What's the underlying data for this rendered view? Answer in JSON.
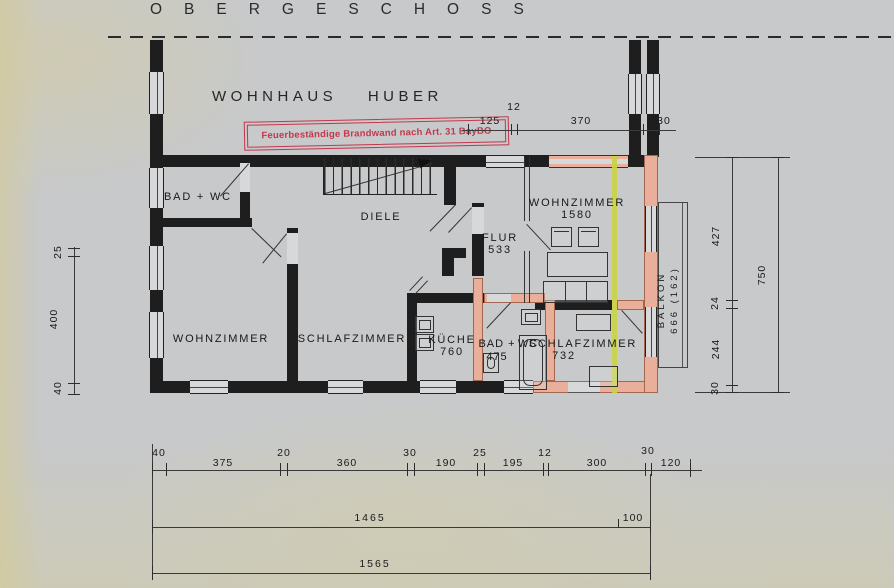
{
  "title": "OBERGESCHOSS",
  "building_label": "WOHNHAUS HUBER",
  "stamp": {
    "text": "Feuerbeständige Brandwand nach Art. 31 BayBO"
  },
  "rooms": {
    "bad_wc_top": {
      "label": "BAD + WC"
    },
    "diele": {
      "label": "DIELE"
    },
    "wohnzimmer_left": {
      "label": "WOHNZIMMER"
    },
    "schlafzimmer_left": {
      "label": "SCHLAFZIMMER"
    },
    "kueche": {
      "label": "KÜCHE",
      "area": "760"
    },
    "flur": {
      "label": "FLUR",
      "area": "533"
    },
    "bad_wc_new": {
      "label_left": "BAD +",
      "label_right": "WC",
      "area": "475"
    },
    "wohnzimmer_new": {
      "label": "WOHNZIMMER",
      "area": "1580"
    },
    "schlafzimmer_new": {
      "label": "SCHLAFZIMMER",
      "area": "732"
    },
    "balkon": {
      "label": "BALKON",
      "area": "666 (162)"
    }
  },
  "dims": {
    "top": [
      "125",
      "12",
      "370",
      "30"
    ],
    "left": [
      "25",
      "400",
      "40"
    ],
    "right_inner": [
      "427",
      "24",
      "244",
      "30"
    ],
    "right_outer": "750",
    "bottom_row1": [
      "40",
      "375",
      "20",
      "360",
      "30",
      "190",
      "25",
      "195",
      "12",
      "300",
      "30",
      "120"
    ],
    "bottom_row2": [
      "1465",
      "100"
    ],
    "bottom_row3": "1565"
  },
  "colors": {
    "wall_black": "#1e1e1e",
    "wall_new_pink": "#e9af9b",
    "firewall_yellow": "#c9d443",
    "stamp_red": "#c4374b",
    "paper_gray": "#c7c9cb"
  }
}
